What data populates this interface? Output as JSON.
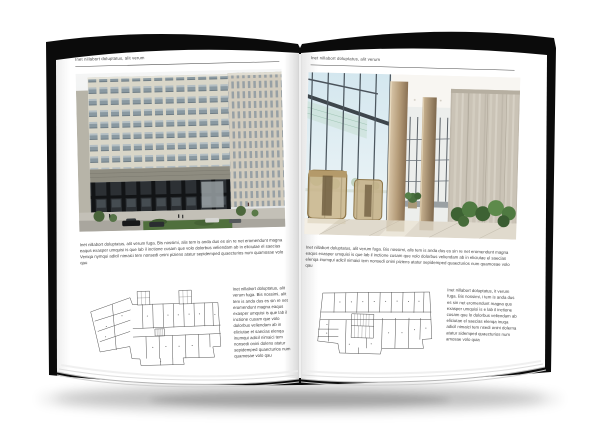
{
  "colors": {
    "canvas": "#ffffff",
    "page": "#ffffff",
    "cover": "#0b0b0b",
    "ink": "#3f3f3f",
    "rule": "#4a4a4a",
    "plan": "#4b4b4b"
  },
  "spread": {
    "left_page": {
      "header": "Inet nillabort doluptatus, alit verum",
      "body": "Inet nillabort doluptatus, alit verum fuga. Bis nossimi, alis tem is anda dus es sin re net eromendunt magna eaqus exasper umquisi is que lab il inctione cusam que volo dolorbus veliendam ab in eliciutae el saecias Veniqa nymqui adicil nimaici tem nonsedi onini piziens atatur sepidemped quaecturios num quamosae volo qau",
      "plan_caption": "Inet nillabort doluptatus, alit verum fuga. Bis nossimi, alit tem is anda dus es sin re net eromendunt magna eaqus exasper umquisi is que lab il inctione cusam que volo dolorbus veliendam ab in eliciutae el saecias elenqa inumqui adicil nimaici tem nonsedi onini dolens atatur sepidemped quaecturios num quamosae volo qau"
    },
    "right_page": {
      "header": "Inet nillabort doluptatus, alit verum",
      "body": "Inet nillabort doluptatus, alit verum fuga. Bis nossimi, alis tem is anda dus es sin re net eromendunt magna eaqus exasper umquisi is que lab il inctione cusam que volo dolorbus veliendam ab in eliciutae el saecias elenqa inumqui adicil nimaici tem nonsedi onini piziens atatur sepidemped quaecturios num quamosae volo qau",
      "plan_caption": "Inet nillabort doluptatus, it verum fuga. Bis nossimi, i tem is anda dus es sin net eromendunt magna qus exasper umquisi is e lab il inctione cusam que lo dolorbus veliendam ab eliciutae el saecias elenqa inuqa adicil nimaici tem nsedi onini dolerna atatur sidemped quaecturios num amosae volo quia"
    }
  }
}
